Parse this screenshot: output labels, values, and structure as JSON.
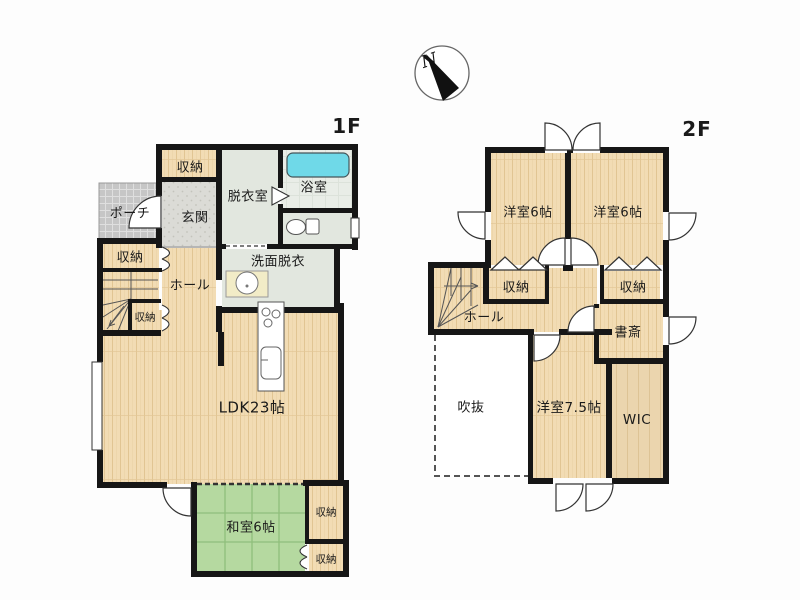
{
  "compass": {
    "north_label": "N"
  },
  "floor1": {
    "floor_label": "1F",
    "rooms": {
      "porch": "ポーチ",
      "entrance_storage": "収納",
      "entrance": "玄関",
      "dressing_room": "脱衣室",
      "bathroom": "浴室",
      "washroom": "洗面脱衣",
      "hall": "ホール",
      "storage_a": "収納",
      "storage_b": "収納",
      "ldk": "LDK23帖",
      "japanese_room": "和室6帖",
      "storage_c": "収納",
      "storage_d": "収納"
    }
  },
  "floor2": {
    "floor_label": "2F",
    "rooms": {
      "bedroom_left": "洋室6帖",
      "bedroom_right": "洋室6帖",
      "storage_left": "収納",
      "storage_right": "収納",
      "hall": "ホール",
      "study": "書斎",
      "void": "吹抜",
      "bedroom_main": "洋室7.5帖",
      "wic": "WIC"
    }
  },
  "icons": {
    "compass": "north-arrow",
    "bathtub": "bathtub",
    "toilet": "toilet",
    "washbasin": "washbasin",
    "kitchen": "counter-with-stove-and-sink",
    "stairs": "winder-staircase"
  },
  "colors": {
    "wall": "#161616",
    "wood_floor": "#F2DCB4",
    "tatami": "#B5D9A0",
    "wet_room": "#E2E7DF",
    "bathtub": "#6FD9E8",
    "porch": "#C7C7C7",
    "entrance_tile": "#DBDBD6"
  }
}
